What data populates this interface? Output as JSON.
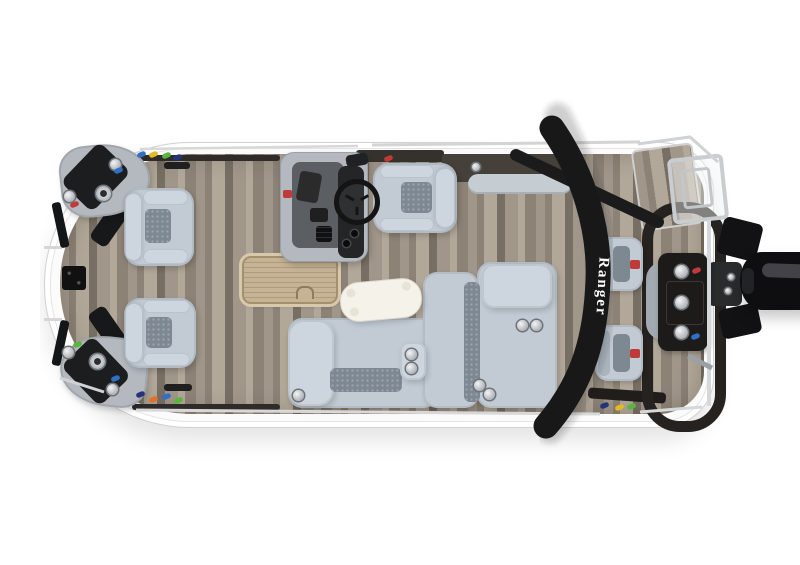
{
  "meta": {
    "scene_title": "Fishing pontoon boat — overhead deck-plan view",
    "view": "top-down product photo on white studio background"
  },
  "branding": {
    "arch_logo": "Ranger"
  },
  "palette": {
    "background": "#ffffff",
    "hull": "#fbfbfb",
    "wood_light": "#b2a89a",
    "wood_mid": "#a0968a",
    "wood_dark": "#8c8276",
    "wood_deep": "#786f64",
    "upholstery": "#c2cbd4",
    "upholstery_light": "#cdd6de",
    "mesh_insert": "#7e8893",
    "charcoal_panel": "#45403a",
    "black_trim": "#201d1b",
    "arch_black": "#181818",
    "tan_hatch": "#c6b295",
    "chrome": "#d5d8da",
    "accent_red": "#c13a3a",
    "logo_white": "#ffffff",
    "lure_blue": "#2f6fc4",
    "lure_navy": "#26337c",
    "lure_green": "#59b63c",
    "lure_yellow": "#e3b928",
    "lure_orange": "#e0702a",
    "lure_red": "#c13a3a"
  },
  "scene": {
    "bow": [
      "port corner casting deck with cup holders and speaker",
      "starboard corner casting deck with cup holders and speaker",
      "two pedestal fishing chairs",
      "trolling-motor mount plate",
      "bow boarding gate"
    ],
    "midship": [
      "helm console with windscreen, steering wheel and gauges",
      "captain pedestal chair",
      "in-floor storage hatch with tan tread pad",
      "L-shaped lounge seating with chrome cup holders",
      "white cocktail table on pedestal"
    ],
    "stern": [
      "black power arch with Ranger logo",
      "two aft pedestal fishing chairs",
      "aft casting platform with black trim",
      "aft tackle console with three cup holders",
      "swim deck with chrome boarding ladder",
      "black outboard motor on transom bracket"
    ],
    "details": [
      "gray wood-grain vinyl flooring",
      "colorful fishing lures staged on rails",
      "white fencing with chrome rails"
    ]
  }
}
